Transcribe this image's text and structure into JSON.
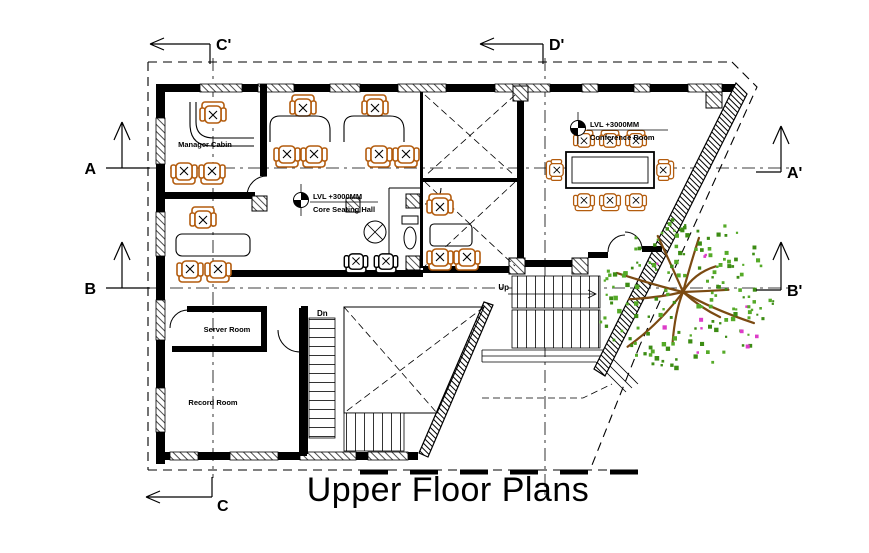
{
  "title": "Upper Floor Plans",
  "section_markers": {
    "c_prime": "C'",
    "d_prime": "D'",
    "c": "C",
    "a": "A",
    "a_prime": "A'",
    "b": "B",
    "b_prime": "B'"
  },
  "rooms": {
    "manager_cabin": "Manager Cabin",
    "server_room": "Server Room",
    "record_room": "Record Room"
  },
  "annotations": {
    "core_hall": {
      "level": "LVL +3000MM",
      "name": "Core Seating Hall"
    },
    "conference_room": {
      "level": "LVL +3000MM",
      "name": "Conference Room"
    }
  },
  "stairs": {
    "down_label": "Dn",
    "up_label": "Up"
  },
  "tree": {
    "cx": 683,
    "cy": 292,
    "r": 86,
    "leaf_count": 175,
    "branch_count": 10
  },
  "colors": {
    "line": "#000000",
    "chair": "#b35c0e",
    "tree_leaf": "#55aa28",
    "tree_leaf_dark": "#3c8c14",
    "tree_branch": "#7b4a12",
    "tree_accent": "#dd3cc8",
    "background": "#ffffff"
  }
}
